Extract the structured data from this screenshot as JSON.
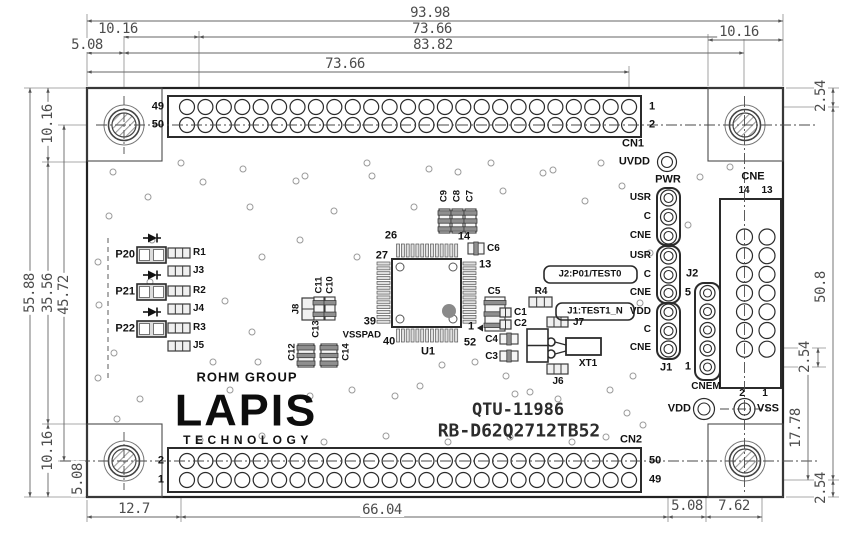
{
  "title": {
    "drawing_no": "QTU-11986",
    "board_name": "RB-D62Q2712TB52"
  },
  "logo": {
    "group": "ROHM GROUP",
    "brand": "LAPIS",
    "sub": "TECHNOLOGY"
  },
  "colors": {
    "line": "#2b2b2b",
    "thin_line": "#8c8c8c",
    "dim_text": "#4d4d4d",
    "pad_fill": "#f0f0f0",
    "band_fill": "#8f8f8f",
    "marker_dot": "#8a8a8a"
  },
  "connectors": {
    "cn1": {
      "label": "CN1",
      "rows": 2,
      "cols": 25
    },
    "cn2": {
      "label": "CN2",
      "rows": 2,
      "cols": 25
    },
    "cne": {
      "label": "CNE",
      "rows": 7,
      "cols": 2
    },
    "cnem": {
      "label": "CNEM",
      "pins": 5
    },
    "j_header": {
      "top_label": "PWR",
      "groups": [
        [
          "USR",
          "C",
          "CNE"
        ],
        [
          "USR",
          "C",
          "CNE"
        ],
        [
          "VDD",
          "C",
          "CNE"
        ]
      ],
      "refs": [
        "J2",
        "J1"
      ]
    },
    "test_points": [
      "UVDD",
      "VDD",
      "VSS"
    ]
  },
  "callouts": [
    "J2:P01/TEST0",
    "J1:TEST1_N"
  ],
  "labels": [
    {
      "n": "cn1-pin-49",
      "t": "49",
      "x": 164,
      "y": 107,
      "a": "e",
      "s": 11
    },
    {
      "n": "cn1-pin-50",
      "t": "50",
      "x": 164,
      "y": 125,
      "a": "e",
      "s": 11
    },
    {
      "n": "cn1-pin-1",
      "t": "1",
      "x": 649,
      "y": 107,
      "a": "w",
      "s": 11
    },
    {
      "n": "cn1-pin-2",
      "t": "2",
      "x": 649,
      "y": 125,
      "a": "w",
      "s": 11
    },
    {
      "n": "cn1-label",
      "t": "CN1",
      "x": 622,
      "y": 144,
      "a": "w",
      "s": 11
    },
    {
      "n": "uvdd-label",
      "t": "UVDD",
      "x": 650,
      "y": 162,
      "a": "e",
      "s": 11
    },
    {
      "n": "pwr-label",
      "t": "PWR",
      "x": 668,
      "y": 180,
      "a": "c",
      "s": 11
    },
    {
      "n": "jh-row-1",
      "t": "USR",
      "x": 651,
      "y": 198,
      "a": "e",
      "s": 10
    },
    {
      "n": "jh-row-2",
      "t": "C",
      "x": 651,
      "y": 217,
      "a": "e",
      "s": 10
    },
    {
      "n": "jh-row-3",
      "t": "CNE",
      "x": 651,
      "y": 236,
      "a": "e",
      "s": 10
    },
    {
      "n": "jh-row-4",
      "t": "USR",
      "x": 651,
      "y": 256,
      "a": "e",
      "s": 10
    },
    {
      "n": "jh-row-5",
      "t": "C",
      "x": 651,
      "y": 275,
      "a": "e",
      "s": 10
    },
    {
      "n": "jh-row-6",
      "t": "CNE",
      "x": 651,
      "y": 293,
      "a": "e",
      "s": 10
    },
    {
      "n": "jh-row-7",
      "t": "VDD",
      "x": 651,
      "y": 312,
      "a": "e",
      "s": 10
    },
    {
      "n": "jh-row-8",
      "t": "C",
      "x": 651,
      "y": 330,
      "a": "e",
      "s": 10
    },
    {
      "n": "jh-row-9",
      "t": "CNE",
      "x": 651,
      "y": 348,
      "a": "e",
      "s": 10
    },
    {
      "n": "j2-label",
      "t": "J2",
      "x": 686,
      "y": 274,
      "a": "w",
      "s": 11
    },
    {
      "n": "j1-label",
      "t": "J1",
      "x": 660,
      "y": 368,
      "a": "w",
      "s": 11
    },
    {
      "n": "cnem-pin-5",
      "t": "5",
      "x": 691,
      "y": 293,
      "a": "e",
      "s": 11
    },
    {
      "n": "cnem-pin-1",
      "t": "1",
      "x": 691,
      "y": 367,
      "a": "e",
      "s": 11
    },
    {
      "n": "cnem-label",
      "t": "CNEM",
      "x": 706,
      "y": 387,
      "a": "c",
      "s": 10
    },
    {
      "n": "cne-label",
      "t": "CNE",
      "x": 753,
      "y": 177,
      "a": "c",
      "s": 11
    },
    {
      "n": "cne-pin-14",
      "t": "14",
      "x": 744,
      "y": 191,
      "a": "c",
      "s": 10
    },
    {
      "n": "cne-pin-13",
      "t": "13",
      "x": 767,
      "y": 191,
      "a": "c",
      "s": 10
    },
    {
      "n": "cne-pin-2",
      "t": "2",
      "x": 742,
      "y": 394,
      "a": "c",
      "s": 10
    },
    {
      "n": "cne-pin-1",
      "t": "1",
      "x": 765,
      "y": 394,
      "a": "c",
      "s": 10
    },
    {
      "n": "vdd-label",
      "t": "VDD",
      "x": 691,
      "y": 409,
      "a": "e",
      "s": 11
    },
    {
      "n": "vss-label",
      "t": "VSS",
      "x": 757,
      "y": 409,
      "a": "w",
      "s": 11
    },
    {
      "n": "cn2-pin-2",
      "t": "2",
      "x": 164,
      "y": 461,
      "a": "e",
      "s": 11
    },
    {
      "n": "cn2-pin-1",
      "t": "1",
      "x": 164,
      "y": 480,
      "a": "e",
      "s": 11
    },
    {
      "n": "cn2-pin-50",
      "t": "50",
      "x": 649,
      "y": 461,
      "a": "w",
      "s": 11
    },
    {
      "n": "cn2-pin-49",
      "t": "49",
      "x": 649,
      "y": 480,
      "a": "w",
      "s": 11
    },
    {
      "n": "cn2-label",
      "t": "CN2",
      "x": 620,
      "y": 440,
      "a": "w",
      "s": 11
    },
    {
      "n": "p20-label",
      "t": "P20",
      "x": 135,
      "y": 255,
      "a": "e",
      "s": 11
    },
    {
      "n": "p21-label",
      "t": "P21",
      "x": 135,
      "y": 292,
      "a": "e",
      "s": 11
    },
    {
      "n": "p22-label",
      "t": "P22",
      "x": 135,
      "y": 329,
      "a": "e",
      "s": 11
    },
    {
      "n": "r1-label",
      "t": "R1",
      "x": 193,
      "y": 253,
      "a": "w",
      "s": 10
    },
    {
      "n": "j3-label",
      "t": "J3",
      "x": 193,
      "y": 271,
      "a": "w",
      "s": 10
    },
    {
      "n": "r2-label",
      "t": "R2",
      "x": 193,
      "y": 291,
      "a": "w",
      "s": 10
    },
    {
      "n": "j4-label",
      "t": "J4",
      "x": 193,
      "y": 309,
      "a": "w",
      "s": 10
    },
    {
      "n": "r3-label",
      "t": "R3",
      "x": 193,
      "y": 328,
      "a": "w",
      "s": 10
    },
    {
      "n": "j5-label",
      "t": "J5",
      "x": 193,
      "y": 346,
      "a": "w",
      "s": 10
    },
    {
      "n": "j8-label",
      "t": "J8",
      "x": 296,
      "y": 309,
      "a": "c",
      "s": 9.5,
      "r": 1
    },
    {
      "n": "c11-label",
      "t": "C11",
      "x": 319,
      "y": 285,
      "a": "c",
      "s": 9.5,
      "r": 1
    },
    {
      "n": "c10-label",
      "t": "C10",
      "x": 330,
      "y": 285,
      "a": "c",
      "s": 9.5,
      "r": 1
    },
    {
      "n": "c13-label",
      "t": "C13",
      "x": 316,
      "y": 329,
      "a": "c",
      "s": 9.5,
      "r": 1
    },
    {
      "n": "c12-label",
      "t": "C12",
      "x": 292,
      "y": 352,
      "a": "c",
      "s": 9.5,
      "r": 1
    },
    {
      "n": "c14-label",
      "t": "C14",
      "x": 346,
      "y": 352,
      "a": "c",
      "s": 9.5,
      "r": 1
    },
    {
      "n": "c9-label",
      "t": "C9",
      "x": 444,
      "y": 196,
      "a": "c",
      "s": 9.5,
      "r": 1
    },
    {
      "n": "c8-label",
      "t": "C8",
      "x": 457,
      "y": 196,
      "a": "c",
      "s": 9.5,
      "r": 1
    },
    {
      "n": "c7-label",
      "t": "C7",
      "x": 470,
      "y": 196,
      "a": "c",
      "s": 9.5,
      "r": 1
    },
    {
      "n": "c6-label",
      "t": "C6",
      "x": 487,
      "y": 249,
      "a": "w",
      "s": 10
    },
    {
      "n": "u1-pin-26",
      "t": "26",
      "x": 391,
      "y": 236,
      "a": "c",
      "s": 11
    },
    {
      "n": "u1-pin-14",
      "t": "14",
      "x": 464,
      "y": 237,
      "a": "c",
      "s": 11
    },
    {
      "n": "u1-pin-27",
      "t": "27",
      "x": 388,
      "y": 256,
      "a": "e",
      "s": 11
    },
    {
      "n": "u1-pin-13",
      "t": "13",
      "x": 479,
      "y": 265,
      "a": "w",
      "s": 11
    },
    {
      "n": "u1-pin-39",
      "t": "39",
      "x": 376,
      "y": 322,
      "a": "e",
      "s": 11
    },
    {
      "n": "vsspad-label",
      "t": "VSSPAD",
      "x": 381,
      "y": 335,
      "a": "e",
      "s": 9.5
    },
    {
      "n": "u1-pin-40",
      "t": "40",
      "x": 383,
      "y": 342,
      "a": "w",
      "s": 11
    },
    {
      "n": "u1-pin-1",
      "t": "1",
      "x": 471,
      "y": 327,
      "a": "c",
      "s": 11
    },
    {
      "n": "u1-pin-52",
      "t": "52",
      "x": 470,
      "y": 343,
      "a": "c",
      "s": 11
    },
    {
      "n": "u1-label",
      "t": "U1",
      "x": 428,
      "y": 352,
      "a": "c",
      "s": 11
    },
    {
      "n": "c5-label",
      "t": "C5",
      "x": 494,
      "y": 292,
      "a": "c",
      "s": 10
    },
    {
      "n": "c1-label",
      "t": "C1",
      "x": 514,
      "y": 313,
      "a": "w",
      "s": 10
    },
    {
      "n": "c2-label",
      "t": "C2",
      "x": 514,
      "y": 324,
      "a": "w",
      "s": 10
    },
    {
      "n": "c4-label",
      "t": "C4",
      "x": 498,
      "y": 340,
      "a": "e",
      "s": 10
    },
    {
      "n": "c3-label",
      "t": "C3",
      "x": 498,
      "y": 357,
      "a": "e",
      "s": 10
    },
    {
      "n": "r4-label",
      "t": "R4",
      "x": 541,
      "y": 292,
      "a": "c",
      "s": 10
    },
    {
      "n": "j7-label",
      "t": "J7",
      "x": 573,
      "y": 323,
      "a": "w",
      "s": 10
    },
    {
      "n": "xt1-label",
      "t": "XT1",
      "x": 588,
      "y": 364,
      "a": "c",
      "s": 10
    },
    {
      "n": "j6-label",
      "t": "J6",
      "x": 558,
      "y": 382,
      "a": "c",
      "s": 10
    },
    {
      "n": "callout-j2",
      "t": "J2:P01/TEST0",
      "x": 590,
      "y": 274,
      "a": "c",
      "s": 9.5
    },
    {
      "n": "callout-j1",
      "t": "J1:TEST1_N",
      "x": 595,
      "y": 311,
      "a": "c",
      "s": 9.5
    }
  ],
  "dimensions": [
    {
      "n": "dim-width-total",
      "t": "93.98",
      "x1": 87,
      "y1": 21,
      "x2": 783,
      "y2": 21,
      "lx": 430,
      "ly": 13
    },
    {
      "n": "dim-top-left-offset",
      "t": "10.16",
      "x1": 124,
      "y1": 37,
      "x2": 199,
      "y2": 37,
      "lx": 118,
      "ly": 29
    },
    {
      "n": "dim-top-span",
      "t": "73.66",
      "x1": 199,
      "y1": 37,
      "x2": 744,
      "y2": 37,
      "lx": 432,
      "ly": 29
    },
    {
      "n": "dim-top-right-offset",
      "t": "10.16",
      "x1": 708,
      "y1": 40,
      "x2": 783,
      "y2": 40,
      "lx": 739,
      "ly": 32
    },
    {
      "n": "dim-top-edge",
      "t": "5.08",
      "x1": 87,
      "y1": 53,
      "x2": 124,
      "y2": 53,
      "lx": 87,
      "ly": 45
    },
    {
      "n": "dim-hole-span",
      "t": "83.82",
      "x1": 124,
      "y1": 53,
      "x2": 744,
      "y2": 53,
      "lx": 433,
      "ly": 45
    },
    {
      "n": "dim-cn1-span",
      "t": "73.66",
      "x1": 87,
      "y1": 72,
      "x2": 629,
      "y2": 72,
      "lx": 345,
      "ly": 64
    },
    {
      "n": "dim-height-total",
      "t": "55.88",
      "x1": 30,
      "y1": 88,
      "x2": 30,
      "y2": 497,
      "lx": 30,
      "ly": 293,
      "r": 1
    },
    {
      "n": "dim-left-top",
      "t": "10.16",
      "x1": 48,
      "y1": 88,
      "x2": 48,
      "y2": 162,
      "lx": 48,
      "ly": 124,
      "r": 1
    },
    {
      "n": "dim-left-mid",
      "t": "35.56",
      "x1": 48,
      "y1": 162,
      "x2": 48,
      "y2": 424,
      "lx": 48,
      "ly": 293,
      "r": 1
    },
    {
      "n": "dim-left-bottom",
      "t": "10.16",
      "x1": 48,
      "y1": 424,
      "x2": 48,
      "y2": 497,
      "lx": 48,
      "ly": 451,
      "r": 1
    },
    {
      "n": "dim-row-span",
      "t": "45.72",
      "x1": 64,
      "y1": 125,
      "x2": 64,
      "y2": 461,
      "lx": 64,
      "ly": 295,
      "r": 1
    },
    {
      "n": "dim-bottom-edge",
      "t": "5.08",
      "x1": 78,
      "y1": 461,
      "x2": 78,
      "y2": 497,
      "lx": 78,
      "ly": 479,
      "r": 1
    },
    {
      "n": "dim-right-top",
      "t": "2.54",
      "x1": 833,
      "y1": 88,
      "x2": 833,
      "y2": 107,
      "lx": 821,
      "ly": 96,
      "r": 1
    },
    {
      "n": "dim-right-span",
      "t": "50.8",
      "x1": 833,
      "y1": 107,
      "x2": 833,
      "y2": 480,
      "lx": 821,
      "ly": 287,
      "r": 1
    },
    {
      "n": "dim-right-bottom",
      "t": "2.54",
      "x1": 833,
      "y1": 480,
      "x2": 833,
      "y2": 497,
      "lx": 821,
      "ly": 488,
      "r": 1
    },
    {
      "n": "dim-cne-pitch",
      "t": "2.54",
      "x1": 818,
      "y1": 348,
      "x2": 818,
      "y2": 367,
      "lx": 805,
      "ly": 357,
      "r": 1
    },
    {
      "n": "dim-cne-offset",
      "t": "17.78",
      "x1": 808,
      "y1": 348,
      "x2": 808,
      "y2": 480,
      "lx": 796,
      "ly": 428,
      "r": 1
    },
    {
      "n": "dim-cn2-left",
      "t": "12.7",
      "x1": 87,
      "y1": 517,
      "x2": 181,
      "y2": 517,
      "lx": 134,
      "ly": 509
    },
    {
      "n": "dim-cn2-span",
      "t": "66.04",
      "x1": 181,
      "y1": 517,
      "x2": 668,
      "y2": 517,
      "lx": 382,
      "ly": 510
    },
    {
      "n": "dim-j1-offset",
      "t": "5.08",
      "x1": 668,
      "y1": 517,
      "x2": 706,
      "y2": 517,
      "lx": 687,
      "ly": 506
    },
    {
      "n": "dim-vss-offset",
      "t": "7.62",
      "x1": 706,
      "y1": 517,
      "x2": 762,
      "y2": 517,
      "lx": 734,
      "ly": 506
    }
  ]
}
